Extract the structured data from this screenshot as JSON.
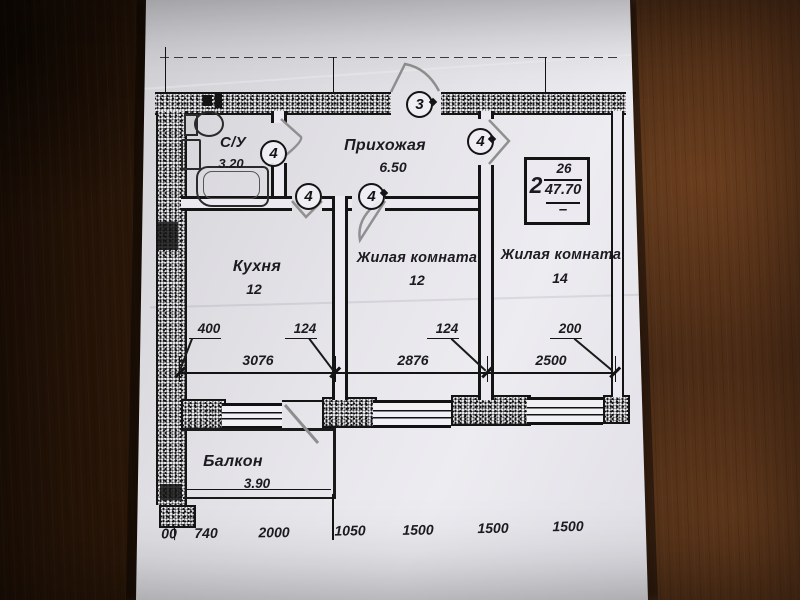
{
  "scene": {
    "description": "Photo of a Russian apartment floor plan (BTI drawing) lying on a dark wooden table",
    "wood_color": "#351e0d",
    "paper_color": "#e7e6eb",
    "ink_color": "#141414",
    "door_swing_color": "#8e8e8e"
  },
  "plan": {
    "rooms": [
      {
        "id": "bathroom",
        "name": "С/У",
        "area": "3.20"
      },
      {
        "id": "hallway",
        "name": "Прихожая",
        "area": "6.50"
      },
      {
        "id": "kitchen",
        "name": "Кухня",
        "area": "12"
      },
      {
        "id": "living-room-1",
        "name": "Жилая комната",
        "area": "12"
      },
      {
        "id": "living-room-2",
        "name": "Жилая комната",
        "area": "14"
      },
      {
        "id": "balcony",
        "name": "Балкон",
        "area": "3.90"
      }
    ],
    "door_tags": {
      "entrance": "3",
      "bathroom": "4",
      "kitchen": "4",
      "living1": "4",
      "living2": "4"
    },
    "stamp": {
      "rooms_count": "2",
      "apartment_number": "26",
      "total_area": "47.70",
      "bottom_mark": "–"
    },
    "dimensions": {
      "wall_leaders": {
        "left": "400",
        "mid1": "124",
        "mid2": "124",
        "right": "200"
      },
      "spans": {
        "kitchen": "3076",
        "living1": "2876",
        "living2": "2500"
      },
      "bottom_row": [
        "00",
        "740",
        "2000",
        "1050",
        "1500",
        "1500",
        "1500"
      ]
    }
  }
}
